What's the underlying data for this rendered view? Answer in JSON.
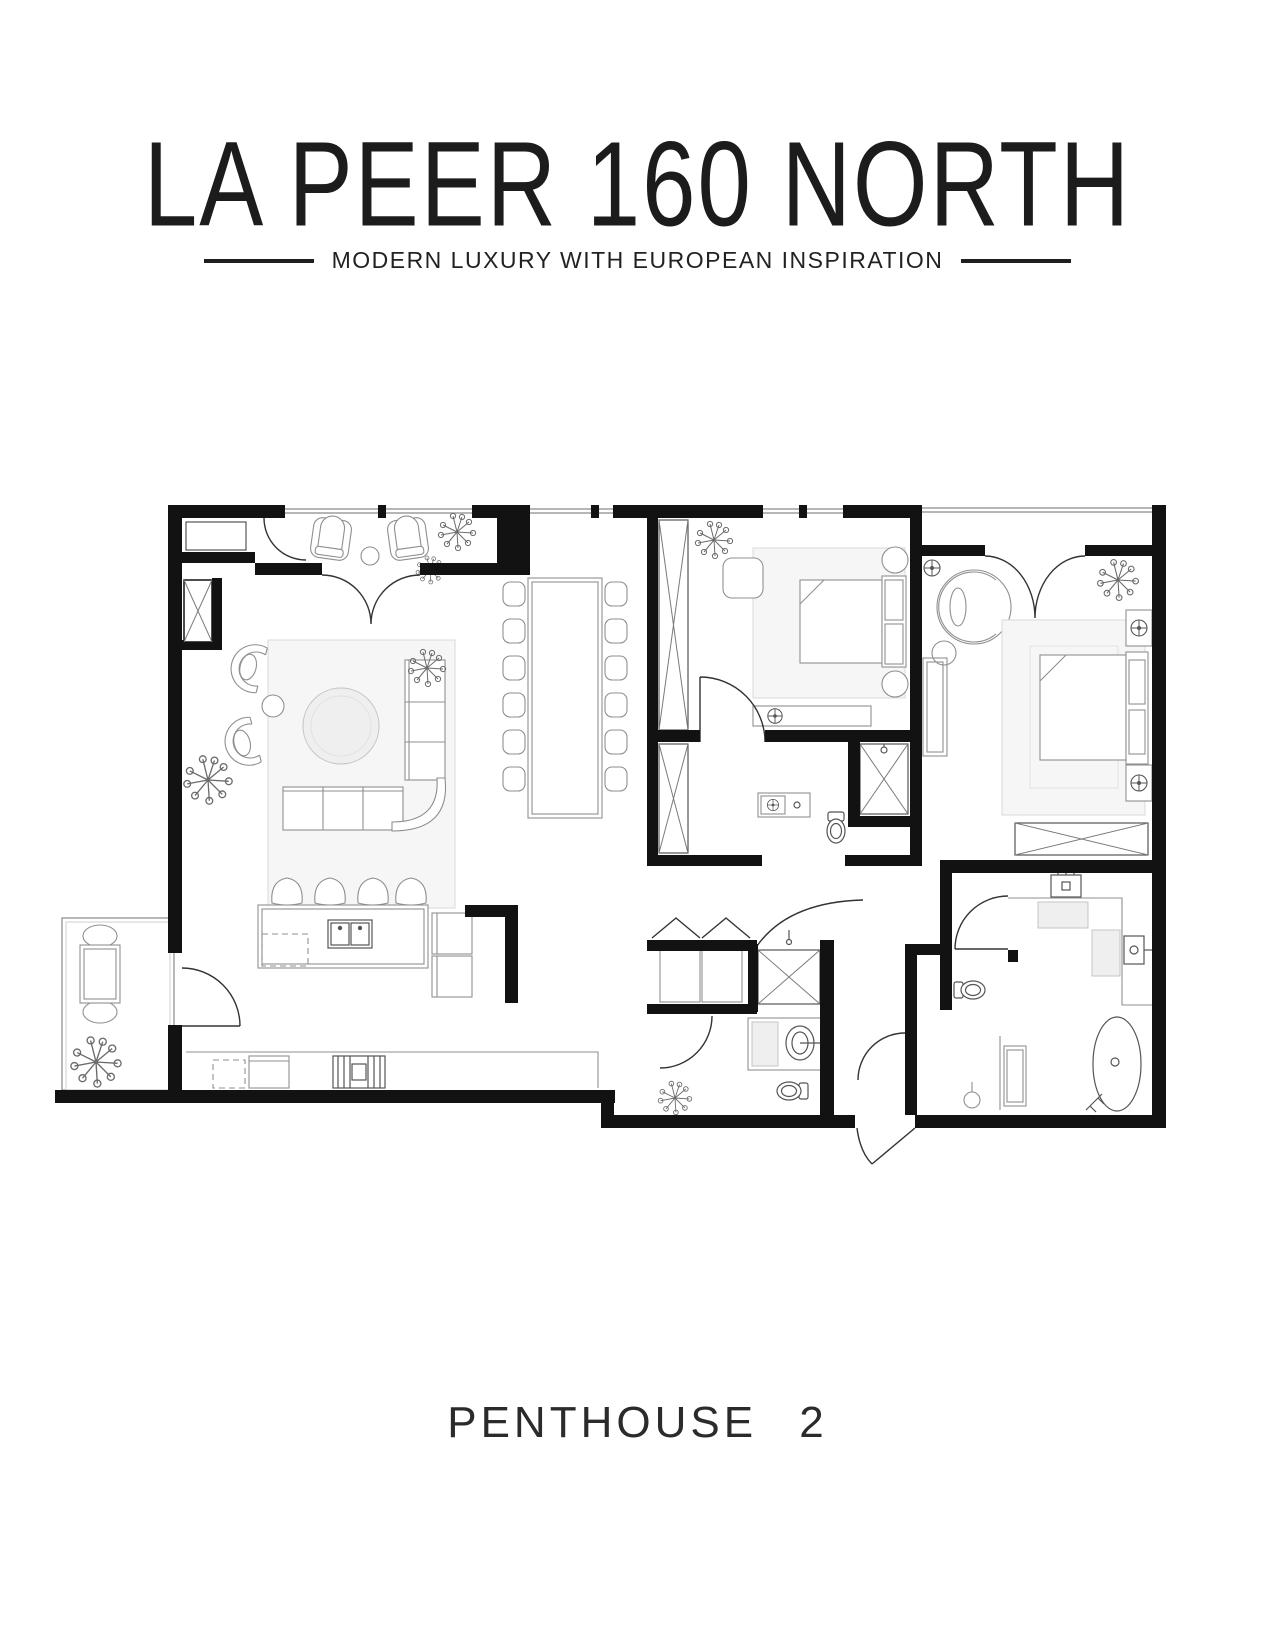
{
  "header": {
    "title": "LA PEER 160 NORTH",
    "tagline": "MODERN LUXURY WITH EUROPEAN INSPIRATION"
  },
  "footer": {
    "label": "PENTHOUSE 2"
  },
  "floor_plan": {
    "wall_color": "#121212",
    "furniture_line_color": "#8f8f8f",
    "rug_color": "#f6f6f6",
    "rooms": [
      "entry-foyer",
      "living-room",
      "dining-area",
      "kitchen",
      "balcony",
      "bedroom-2",
      "bathroom-2",
      "walk-in-closet",
      "powder-room",
      "entry-hall",
      "primary-bedroom",
      "primary-bathroom",
      "water-closet"
    ]
  }
}
